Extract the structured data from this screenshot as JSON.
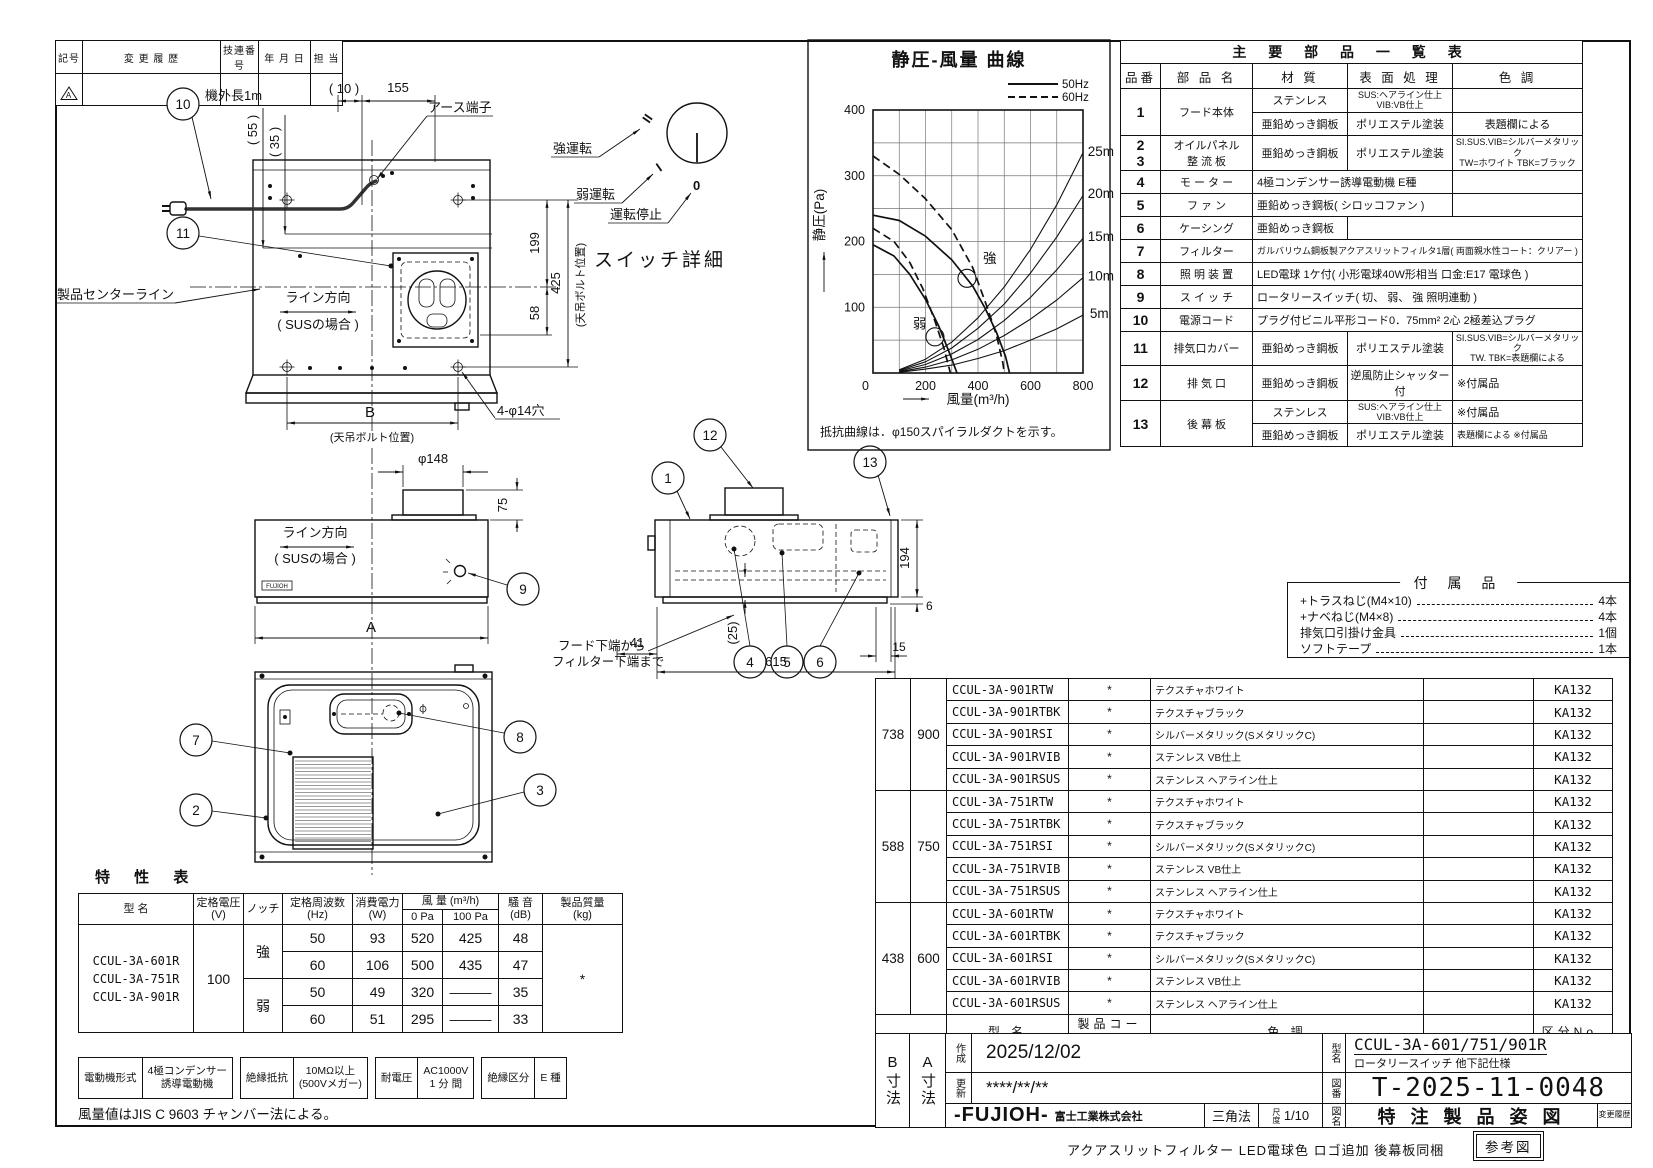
{
  "revision_table": {
    "headers": [
      "記号",
      "変 更 履 歴",
      "技連番号",
      "年 月 日",
      "担 当"
    ],
    "symbol": "A"
  },
  "chart_data": {
    "type": "line",
    "title": "静圧-風量  曲線",
    "xlabel": "風量(m³/h)",
    "ylabel": "静圧(Pa)",
    "xlim": [
      0,
      800
    ],
    "ylim": [
      0,
      400
    ],
    "grid_step_x": 100,
    "grid_step_y": 50,
    "x_ticks": [
      0,
      200,
      400,
      600,
      800
    ],
    "y_ticks": [
      100,
      200,
      300,
      400
    ],
    "legend": {
      "hz50": "50Hz",
      "hz60": "60Hz"
    },
    "note": "抵抗曲線は．φ150スパイラルダクトを示す。",
    "series": [
      {
        "name": "強 50Hz",
        "points": [
          [
            0,
            240
          ],
          [
            100,
            232
          ],
          [
            200,
            208
          ],
          [
            300,
            172
          ],
          [
            380,
            132
          ],
          [
            425,
            100
          ],
          [
            470,
            62
          ],
          [
            505,
            25
          ],
          [
            520,
            0
          ]
        ]
      },
      {
        "name": "強 60Hz",
        "dashed": true,
        "points": [
          [
            0,
            330
          ],
          [
            100,
            302
          ],
          [
            200,
            265
          ],
          [
            300,
            218
          ],
          [
            380,
            160
          ],
          [
            435,
            100
          ],
          [
            470,
            58
          ],
          [
            495,
            15
          ],
          [
            500,
            0
          ]
        ]
      },
      {
        "name": "弱 50Hz",
        "points": [
          [
            0,
            195
          ],
          [
            80,
            178
          ],
          [
            140,
            150
          ],
          [
            200,
            112
          ],
          [
            250,
            72
          ],
          [
            290,
            32
          ],
          [
            320,
            0
          ]
        ]
      },
      {
        "name": "弱 60Hz",
        "dashed": true,
        "points": [
          [
            0,
            220
          ],
          [
            80,
            200
          ],
          [
            140,
            168
          ],
          [
            190,
            128
          ],
          [
            235,
            80
          ],
          [
            270,
            38
          ],
          [
            295,
            0
          ]
        ]
      },
      {
        "name": "抵抗曲線 5m",
        "thin": true,
        "points": [
          [
            100,
            1
          ],
          [
            200,
            6
          ],
          [
            300,
            12
          ],
          [
            400,
            22
          ],
          [
            500,
            34
          ],
          [
            600,
            50
          ],
          [
            700,
            67
          ],
          [
            800,
            88
          ]
        ]
      },
      {
        "name": "抵抗曲線 10m",
        "thin": true,
        "points": [
          [
            100,
            2
          ],
          [
            200,
            9
          ],
          [
            300,
            20
          ],
          [
            400,
            36
          ],
          [
            500,
            57
          ],
          [
            600,
            82
          ],
          [
            700,
            111
          ],
          [
            800,
            145
          ]
        ]
      },
      {
        "name": "抵抗曲線 15m",
        "thin": true,
        "points": [
          [
            100,
            3
          ],
          [
            200,
            13
          ],
          [
            300,
            29
          ],
          [
            400,
            51
          ],
          [
            500,
            80
          ],
          [
            600,
            115
          ],
          [
            700,
            157
          ],
          [
            800,
            205
          ]
        ]
      },
      {
        "name": "抵抗曲線 20m",
        "thin": true,
        "points": [
          [
            100,
            4
          ],
          [
            200,
            17
          ],
          [
            300,
            38
          ],
          [
            400,
            68
          ],
          [
            500,
            105
          ],
          [
            600,
            152
          ],
          [
            700,
            207
          ],
          [
            800,
            270
          ]
        ]
      },
      {
        "name": "抵抗曲線 25m",
        "thin": true,
        "points": [
          [
            100,
            5
          ],
          [
            200,
            21
          ],
          [
            300,
            47
          ],
          [
            400,
            84
          ],
          [
            500,
            131
          ],
          [
            600,
            188
          ],
          [
            700,
            256
          ],
          [
            800,
            335
          ]
        ]
      }
    ],
    "annotations": [
      {
        "text": "強",
        "q": 419,
        "p": 167,
        "circle": true,
        "cq": 358,
        "cp": 144
      },
      {
        "text": "弱",
        "q": 152,
        "p": 68,
        "circle": true,
        "cq": 236,
        "cp": 55
      },
      {
        "text": "25m",
        "q": 818,
        "p": 330
      },
      {
        "text": "20m",
        "q": 818,
        "p": 266
      },
      {
        "text": "15m",
        "q": 818,
        "p": 201
      },
      {
        "text": "10m",
        "q": 818,
        "p": 141
      },
      {
        "text": "5m",
        "q": 826,
        "p": 84
      }
    ]
  },
  "parts_table": {
    "rows": [
      [
        {
          "t": "主 要 部 品 一 覧 表",
          "cs": 5,
          "cls": "ttl"
        }
      ],
      [
        {
          "t": "品番",
          "cls": "hd"
        },
        {
          "t": "部 品 名",
          "cls": "hd"
        },
        {
          "t": "材  質",
          "cls": "hd"
        },
        {
          "t": "表 面 処 理",
          "cls": "hd"
        },
        {
          "t": "色  調",
          "cls": "hd"
        }
      ],
      [
        {
          "t": "1",
          "rs": 2,
          "cls": "no"
        },
        {
          "t": "フード本体",
          "rs": 2
        },
        {
          "t": "ステンレス"
        },
        {
          "t": "SUS:ヘアライン仕上 VIB:VB仕上",
          "cls": "sm"
        },
        {
          "t": ""
        }
      ],
      [
        {
          "t": "亜鉛めっき鋼板"
        },
        {
          "t": "ポリエステル塗装"
        },
        {
          "t": "表題欄による"
        }
      ],
      [
        {
          "t": "2\n3",
          "cls": "no"
        },
        {
          "t": "オイルパネル\n整 流 板"
        },
        {
          "t": "亜鉛めっき鋼板"
        },
        {
          "t": "ポリエステル塗装"
        },
        {
          "t": "SI.SUS.VIB=シルバーメタリック\nTW=ホワイト TBK=ブラック",
          "cls": "sm"
        }
      ],
      [
        {
          "t": "4",
          "cls": "no"
        },
        {
          "t": "モ ー タ ー"
        },
        {
          "t": "4極コンデンサー誘導電動機  E種",
          "cs": 2,
          "cls": "lt"
        },
        {
          "t": ""
        }
      ],
      [
        {
          "t": "5",
          "cls": "no"
        },
        {
          "t": "フ ァ ン"
        },
        {
          "t": "亜鉛めっき鋼板( シロッコファン )",
          "cs": 2,
          "cls": "lt"
        },
        {
          "t": ""
        }
      ],
      [
        {
          "t": "6",
          "cls": "no"
        },
        {
          "t": "ケーシング"
        },
        {
          "t": "亜鉛めっき鋼板",
          "cls": "lt"
        },
        {
          "t": "",
          "cs": 2
        }
      ],
      [
        {
          "t": "7",
          "cls": "no"
        },
        {
          "t": "フィルター"
        },
        {
          "t": "ガルバリウム鋼板製アクアスリットフィルタ1層( 両面親水性コート：クリアー )",
          "cs": 3,
          "cls": "sm lt"
        }
      ],
      [
        {
          "t": "8",
          "cls": "no"
        },
        {
          "t": "照 明 装 置"
        },
        {
          "t": "LED電球  1ケ付( 小形電球40W形相当  口金:E17  電球色 )",
          "cs": 3,
          "cls": "lt"
        }
      ],
      [
        {
          "t": "9",
          "cls": "no"
        },
        {
          "t": "ス イ ッ チ"
        },
        {
          "t": "ロータリースイッチ( 切、 弱、 強    照明連動 )",
          "cs": 3,
          "cls": "lt"
        }
      ],
      [
        {
          "t": "10",
          "cls": "no"
        },
        {
          "t": "電源コード"
        },
        {
          "t": "プラグ付ビニル平形コード0．75mm²  2心  2極差込プラグ",
          "cs": 3,
          "cls": "lt"
        }
      ],
      [
        {
          "t": "11",
          "cls": "no"
        },
        {
          "t": "排気口カバー"
        },
        {
          "t": "亜鉛めっき鋼板"
        },
        {
          "t": "ポリエステル塗装"
        },
        {
          "t": "SI.SUS.VIB=シルバーメタリック\nTW. TBK=表題欄による",
          "cls": "sm"
        }
      ],
      [
        {
          "t": "12",
          "cls": "no"
        },
        {
          "t": "排 気 口"
        },
        {
          "t": "亜鉛めっき鋼板"
        },
        {
          "t": "逆風防止シャッター付"
        },
        {
          "t": "※付属品",
          "cls": "lt"
        }
      ],
      [
        {
          "t": "13",
          "rs": 2,
          "cls": "no"
        },
        {
          "t": "後 幕 板",
          "rs": 2
        },
        {
          "t": "ステンレス"
        },
        {
          "t": "SUS:ヘアライン仕上 VIB:VB仕上",
          "cls": "sm"
        },
        {
          "t": "※付属品",
          "cls": "lt"
        }
      ],
      [
        {
          "t": "亜鉛めっき鋼板"
        },
        {
          "t": "ポリエステル塗装"
        },
        {
          "t": "表題欄による ※付属品",
          "cls": "sm lt"
        }
      ]
    ]
  },
  "accessories": {
    "title": "付 属 品",
    "items": [
      {
        "name": "+トラスねじ(M4×10)",
        "qty": "4本"
      },
      {
        "name": "+ナベねじ(M4×8)",
        "qty": "4本"
      },
      {
        "name": "排気口引掛け金具",
        "qty": "1個"
      },
      {
        "name": "ソフトテープ",
        "qty": "1本"
      }
    ]
  },
  "model_table": {
    "code_mark": "*",
    "kubun": "KA132",
    "groups": [
      {
        "b": "738",
        "a": "900",
        "rows": [
          {
            "model": "CCUL-3A-901RTW",
            "color": "テクスチャホワイト"
          },
          {
            "model": "CCUL-3A-901RTBK",
            "color": "テクスチャブラック"
          },
          {
            "model": "CCUL-3A-901RSI",
            "color": "シルバーメタリック(SメタリックC)"
          },
          {
            "model": "CCUL-3A-901RVIB",
            "color": "ステンレス VB仕上"
          },
          {
            "model": "CCUL-3A-901RSUS",
            "color": "ステンレス ヘアライン仕上"
          }
        ]
      },
      {
        "b": "588",
        "a": "750",
        "rows": [
          {
            "model": "CCUL-3A-751RTW",
            "color": "テクスチャホワイト"
          },
          {
            "model": "CCUL-3A-751RTBK",
            "color": "テクスチャブラック"
          },
          {
            "model": "CCUL-3A-751RSI",
            "color": "シルバーメタリック(SメタリックC)"
          },
          {
            "model": "CCUL-3A-751RVIB",
            "color": "ステンレス VB仕上"
          },
          {
            "model": "CCUL-3A-751RSUS",
            "color": "ステンレス ヘアライン仕上"
          }
        ]
      },
      {
        "b": "438",
        "a": "600",
        "rows": [
          {
            "model": "CCUL-3A-601RTW",
            "color": "テクスチャホワイト"
          },
          {
            "model": "CCUL-3A-601RTBK",
            "color": "テクスチャブラック"
          },
          {
            "model": "CCUL-3A-601RSI",
            "color": "シルバーメタリック(SメタリックC)"
          },
          {
            "model": "CCUL-3A-601RVIB",
            "color": "ステンレス VB仕上"
          },
          {
            "model": "CCUL-3A-601RSUS",
            "color": "ステンレス ヘアライン仕上"
          }
        ]
      }
    ],
    "footer": [
      "型  名",
      "製品コード",
      "色  調",
      "",
      "区分No."
    ]
  },
  "char_table": {
    "title": "特  性  表",
    "rows": [
      [
        {
          "t": "型   名",
          "rs": 2,
          "cls": "h"
        },
        {
          "t": "定格電圧\n(V)",
          "rs": 2,
          "cls": "h"
        },
        {
          "t": "ノッチ",
          "rs": 2,
          "cls": "h"
        },
        {
          "t": "定格周波数\n(Hz)",
          "rs": 2,
          "cls": "h"
        },
        {
          "t": "消費電力\n(W)",
          "rs": 2,
          "cls": "h"
        },
        {
          "t": "風 量  (m³/h)",
          "cs": 2,
          "cls": "h"
        },
        {
          "t": "騒 音\n(dB)",
          "rs": 2,
          "cls": "h"
        },
        {
          "t": "製品質量\n(kg)",
          "rs": 2,
          "cls": "h"
        }
      ],
      [
        {
          "t": "0 Pa",
          "cls": "h"
        },
        {
          "t": "100 Pa",
          "cls": "h"
        }
      ],
      [
        {
          "t": "CCUL-3A-601R\nCCUL-3A-751R\nCCUL-3A-901R",
          "rs": 4,
          "cls": "mod"
        },
        {
          "t": "100",
          "rs": 4
        },
        {
          "t": "強",
          "rs": 2
        },
        {
          "t": "50"
        },
        {
          "t": "93"
        },
        {
          "t": "520"
        },
        {
          "t": "425"
        },
        {
          "t": "48"
        },
        {
          "t": "*",
          "rs": 4
        }
      ],
      [
        {
          "t": "60"
        },
        {
          "t": "106"
        },
        {
          "t": "500"
        },
        {
          "t": "435"
        },
        {
          "t": "47"
        }
      ],
      [
        {
          "t": "弱",
          "rs": 2
        },
        {
          "t": "50"
        },
        {
          "t": "49"
        },
        {
          "t": "320"
        },
        {
          "t": "———"
        },
        {
          "t": "35"
        }
      ],
      [
        {
          "t": "60"
        },
        {
          "t": "51"
        },
        {
          "t": "295"
        },
        {
          "t": "———"
        },
        {
          "t": "33"
        }
      ]
    ],
    "motor_row": [
      [
        "電動機形式",
        "4極コンデンサー\n誘導電動機"
      ],
      [
        "絶縁抵抗",
        "10MΩ以上\n(500Vメガー)"
      ],
      [
        "耐電圧",
        "AC1000V\n1 分 間"
      ],
      [
        "絶縁区分",
        "E  種"
      ]
    ],
    "note": "風量値はJIS C 9603 チャンバー法による。"
  },
  "title_block": {
    "b_dim": "B寸法",
    "a_dim": "A寸法",
    "created_label": "作成",
    "created": "2025/12/02",
    "updated_label": "更新",
    "updated": "****/**/**",
    "model_label": "型名",
    "model": "CCUL-3A-601/751/901R",
    "model_sub": "ロータリースイッチ  他下記仕様",
    "dwgno_label": "図番",
    "dwgno": "T-2025-11-0048",
    "logo": "-FUJIOH-",
    "company": "富士工業株式会社",
    "projection": "三角法",
    "scale_label": "尺度",
    "scale": "1/10",
    "name_label": "図名",
    "dwg_name": "特 注 製 品 姿 図",
    "rev_label": "変更履歴",
    "bottom_note": "アクアスリットフィルター  LED電球色  ロゴ追加  後幕板同梱",
    "ref_label": "参考図"
  },
  "drawings": {
    "back_view": {
      "b10": "10",
      "b11": "11",
      "cord_len": "機外長1m",
      "d10": "( 10 )",
      "d155": "155",
      "d55": "( 55 )",
      "d35": "( 35 )",
      "earth": "アース端子",
      "d199": "199",
      "d425": "425",
      "d58": "58",
      "bolt_pos": "(天吊ボルト位置)",
      "dB": "B",
      "holes": "4-φ14穴",
      "line_dir": "ライン方向",
      "sus": "( SUSの場合 )",
      "center": "製品センターライン"
    },
    "switch_detail": {
      "strong": "強運転",
      "weak": "弱運転",
      "stop": "運転停止",
      "caption": "スイッチ詳細",
      "m2": "II",
      "m1": "I",
      "m0": "0"
    },
    "front_view": {
      "dia": "φ148",
      "d75": "75",
      "line_dir": "ライン方向",
      "sus": "( SUSの場合 )",
      "dA": "A",
      "b9": "9",
      "logo": "FUJIOH"
    },
    "side_view": {
      "b12": "12",
      "b1": "1",
      "b13": "13",
      "b4": "4",
      "b5": "5",
      "b6": "6",
      "d194": "194",
      "d6": "6",
      "d41": "41",
      "d25": "(25)",
      "d615": "615",
      "d15": "15",
      "note1": "フード下端から",
      "note2": "フィルター下端まで"
    },
    "bottom_view": {
      "b7": "7",
      "b2": "2",
      "b3": "3",
      "b8": "8"
    }
  }
}
